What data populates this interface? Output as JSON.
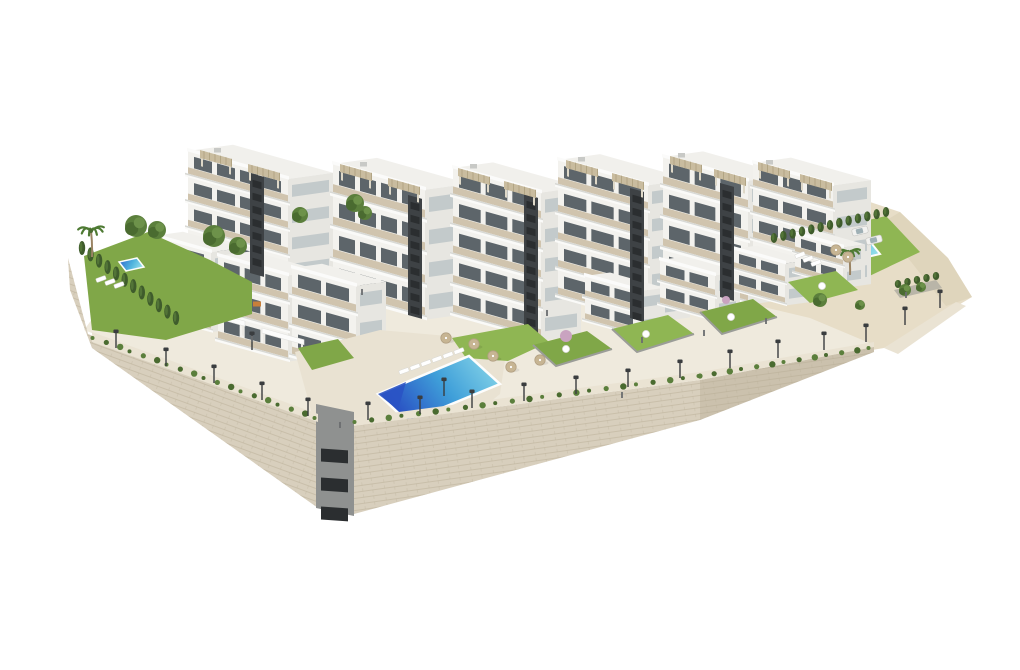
{
  "meta": {
    "type": "architectural-render",
    "description": "Aerial 3D architectural rendering of a white modern terraced apartment complex with communal pools, private lawns, palm trees, cypress hedges and a large stone retaining wall, on a white background",
    "background": "#ffffff"
  },
  "palette": {
    "front": "#f3f2ee",
    "side": "#e7e6e1",
    "roof": "#f1f0ec",
    "slab": "#fafaf8",
    "slab_shadow": "#c9cac6",
    "panel": "#cdc0a8",
    "pergola": "#c9bc9f",
    "pergola_dark": "#b2a584",
    "core": "#3e4245",
    "core_slat": "#2b2e30",
    "window": "#5d656a",
    "side_window": "#c3cacb",
    "glass": "#dfe7ea",
    "ground": "#efeadd",
    "deck": "#e9e2d2",
    "path": "#eae3d3",
    "stone": "#d8cfbd",
    "stone_dark": "#cbc1ad",
    "stone_line": "#b5aa92",
    "sand": "#e7ddc7",
    "sand_shade": "#d8cdb2",
    "lawn": "#80a748",
    "lawn_light": "#8fb653",
    "lawn_dark": "#6f9840",
    "hedge": "#3f5c2c",
    "tree": "#5b7f3c",
    "tree_dark": "#4a6b30",
    "tree_light": "#6d924a",
    "palm": "#4e7a33",
    "trunk": "#9a8464",
    "pink_tree": "#c9a3c0",
    "pool_deep": "#2a53c4",
    "pool_mid": "#3f9fd9",
    "pool_light": "#90dcea",
    "pool_rim": "#fdfdfc",
    "umbrella": "#c7b593",
    "furniture": "#ffffff",
    "lamp": "#3a3d3f",
    "tower": "#8f9190",
    "people": "#6a6d6f",
    "planter": "#b9b5a8"
  },
  "scene": {
    "boxes": [
      {
        "id": "A1",
        "x": 188,
        "y": 256,
        "w": 100,
        "d": 45,
        "h": 105,
        "floors": 4
      },
      {
        "id": "A2",
        "x": 333,
        "y": 294,
        "w": 92,
        "d": 44,
        "h": 130,
        "floors": 4
      },
      {
        "id": "A3",
        "x": 453,
        "y": 316,
        "w": 88,
        "d": 40,
        "h": 148,
        "floors": 5
      },
      {
        "id": "A4",
        "x": 558,
        "y": 298,
        "w": 90,
        "d": 42,
        "h": 138,
        "floors": 5
      },
      {
        "id": "A5",
        "x": 663,
        "y": 281,
        "w": 85,
        "d": 40,
        "h": 124,
        "floors": 4
      },
      {
        "id": "A6",
        "x": 753,
        "y": 267,
        "w": 80,
        "d": 38,
        "h": 104,
        "floors": 4
      },
      {
        "id": "B1",
        "x": 153,
        "y": 316,
        "w": 58,
        "d": 30,
        "h": 80,
        "floors": 3
      },
      {
        "id": "B2",
        "x": 218,
        "y": 342,
        "w": 70,
        "d": 34,
        "h": 86,
        "floors": 3
      },
      {
        "id": "B3",
        "x": 292,
        "y": 358,
        "w": 64,
        "d": 30,
        "h": 90,
        "floors": 3
      },
      {
        "id": "C1",
        "x": 585,
        "y": 322,
        "w": 55,
        "d": 25,
        "h": 46,
        "floors": 2
      },
      {
        "id": "C2",
        "x": 660,
        "y": 306,
        "w": 55,
        "d": 25,
        "h": 46,
        "floors": 2
      },
      {
        "id": "C3",
        "x": 733,
        "y": 291,
        "w": 52,
        "d": 24,
        "h": 42,
        "floors": 2
      },
      {
        "id": "C4",
        "x": 795,
        "y": 274,
        "w": 48,
        "d": 22,
        "h": 40,
        "floors": 2
      }
    ],
    "cores": [
      {
        "x": 250,
        "y": 273,
        "h": 100
      },
      {
        "x": 408,
        "y": 315,
        "h": 120
      },
      {
        "x": 524,
        "y": 336,
        "h": 142
      },
      {
        "x": 630,
        "y": 318,
        "h": 130
      },
      {
        "x": 720,
        "y": 297,
        "h": 114
      }
    ],
    "pergolas": [
      [
        200,
        152
      ],
      [
        248,
        166
      ],
      [
        340,
        166
      ],
      [
        388,
        180
      ],
      [
        458,
        170
      ],
      [
        504,
        183
      ],
      [
        566,
        162
      ],
      [
        612,
        175
      ],
      [
        670,
        158
      ],
      [
        714,
        171
      ],
      [
        758,
        164
      ],
      [
        800,
        176
      ]
    ],
    "white_pergolas": [
      [
        137,
        272,
        33
      ],
      [
        205,
        310,
        40
      ],
      [
        262,
        328,
        42
      ],
      [
        330,
        346,
        40
      ]
    ],
    "roof_units": [
      [
        214,
        148
      ],
      [
        360,
        162
      ],
      [
        470,
        164
      ],
      [
        578,
        157
      ],
      [
        678,
        153
      ],
      [
        766,
        160
      ]
    ],
    "lamps": [
      [
        116,
        348
      ],
      [
        166,
        366
      ],
      [
        214,
        383
      ],
      [
        262,
        400
      ],
      [
        308,
        416
      ],
      [
        368,
        420
      ],
      [
        420,
        414
      ],
      [
        472,
        408
      ],
      [
        524,
        401
      ],
      [
        576,
        394
      ],
      [
        628,
        387
      ],
      [
        680,
        378
      ],
      [
        730,
        368
      ],
      [
        778,
        358
      ],
      [
        824,
        350
      ],
      [
        866,
        342
      ],
      [
        905,
        325
      ],
      [
        940,
        308
      ],
      [
        252,
        350
      ],
      [
        444,
        396
      ]
    ],
    "garlands": [
      [
        94,
        340,
        316,
        420,
        18
      ],
      [
        356,
        424,
        700,
        378,
        22
      ],
      [
        700,
        378,
        870,
        350,
        12
      ]
    ],
    "umbrellas": [
      [
        446,
        338
      ],
      [
        474,
        344
      ],
      [
        493,
        356
      ],
      [
        511,
        367
      ],
      [
        540,
        360
      ],
      [
        836,
        250
      ],
      [
        848,
        257
      ]
    ],
    "loungers": [
      [
        404,
        371
      ],
      [
        415,
        367
      ],
      [
        426,
        363
      ],
      [
        437,
        359
      ],
      [
        448,
        355
      ],
      [
        459,
        351
      ],
      [
        101,
        279
      ],
      [
        110,
        282
      ],
      [
        119,
        285
      ],
      [
        800,
        255
      ],
      [
        808,
        259
      ],
      [
        816,
        263
      ]
    ],
    "tables": [
      [
        566,
        349
      ],
      [
        646,
        334
      ],
      [
        731,
        317
      ],
      [
        822,
        286
      ]
    ],
    "orange_table": [
      257,
      304
    ],
    "trees": [
      [
        136,
        226,
        11
      ],
      [
        157,
        230,
        9
      ],
      [
        214,
        236,
        11
      ],
      [
        238,
        246,
        9
      ],
      [
        300,
        215,
        8
      ],
      [
        355,
        203,
        9
      ],
      [
        365,
        213,
        7
      ],
      [
        820,
        300,
        7
      ],
      [
        905,
        290,
        6
      ],
      [
        921,
        287,
        5
      ],
      [
        860,
        305,
        5
      ]
    ],
    "pink_trees": [
      [
        566,
        336,
        6
      ],
      [
        726,
        300,
        4
      ]
    ],
    "palms": [
      [
        91,
        231,
        13
      ],
      [
        849,
        253,
        11
      ]
    ],
    "hedges": [
      {
        "x1": 82,
        "y1": 248,
        "x2": 176,
        "y2": 318,
        "n": 12,
        "ry": 7
      },
      {
        "x1": 774,
        "y1": 238,
        "x2": 886,
        "y2": 212,
        "n": 13,
        "ry": 5
      },
      {
        "x1": 898,
        "y1": 284,
        "x2": 936,
        "y2": 276,
        "n": 5,
        "ry": 4
      }
    ],
    "people": [
      [
        362,
        295
      ],
      [
        547,
        316
      ],
      [
        642,
        343
      ],
      [
        704,
        336
      ],
      [
        766,
        324
      ],
      [
        906,
        298
      ],
      [
        340,
        428
      ],
      [
        622,
        398
      ],
      [
        252,
        342
      ]
    ],
    "cars": [
      [
        860,
        231
      ],
      [
        874,
        240
      ]
    ]
  }
}
